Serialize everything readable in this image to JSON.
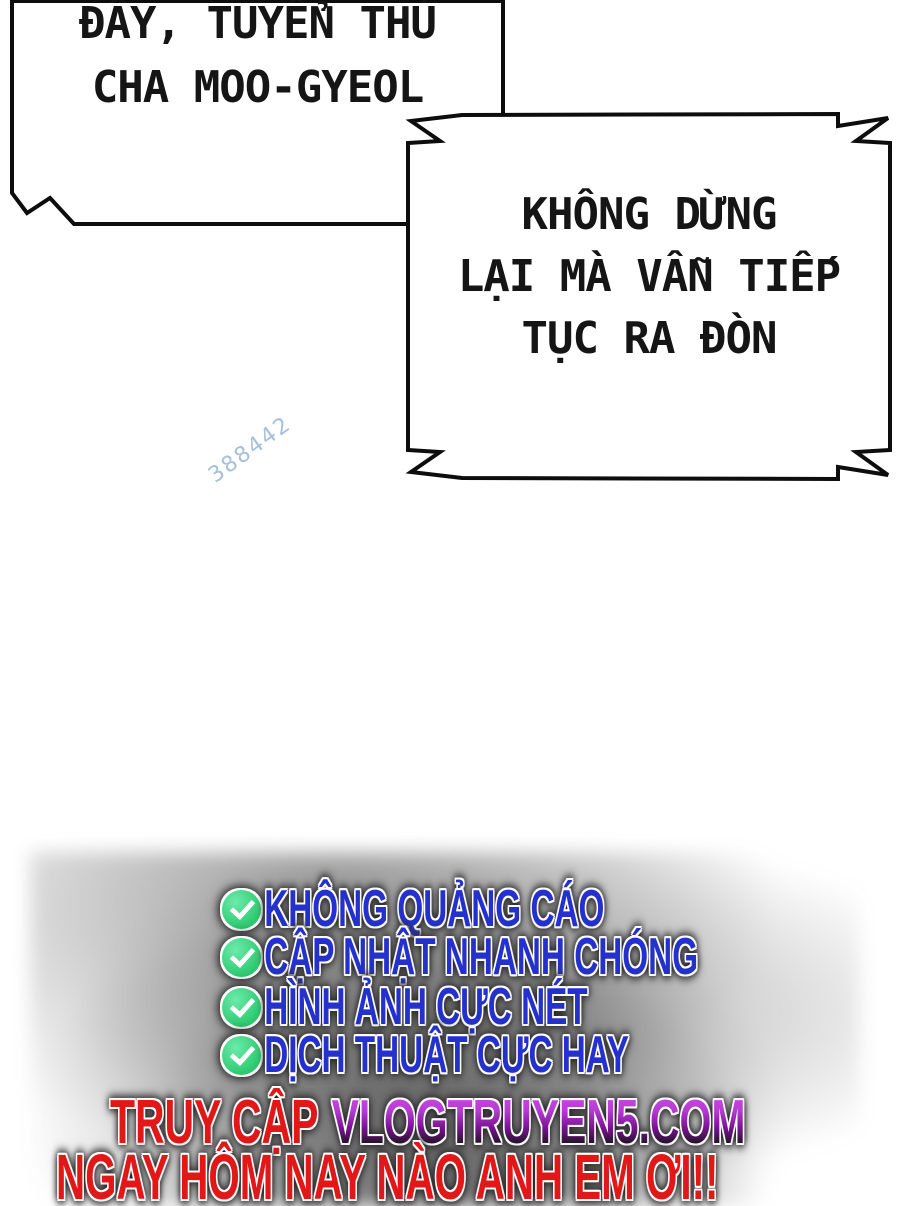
{
  "page": {
    "background": "#ffffff",
    "type": "manhwa-page"
  },
  "bubbles": {
    "bubble1": {
      "lines": [
        "ĐÂY, TUYỂN THỦ",
        "CHA MOO-GYEOL"
      ]
    },
    "bubble2": {
      "lines": [
        "KHÔNG DỪNG",
        "LẠI MÀ VẪN TIẾP",
        "TỤC RA ĐÒN"
      ]
    }
  },
  "watermark": {
    "text": "388442",
    "color": "#a7c0da"
  },
  "promo": {
    "checklist": {
      "icon": "check-circle-icon",
      "items": [
        "KHÔNG QUẢNG CÁO",
        "CẬP NHẬT NHANH CHÓNG",
        "HÌNH ẢNH CỰC NÉT",
        "DỊCH THUẬT CỰC HAY"
      ]
    },
    "cta": {
      "prefix": "TRUY CẬP",
      "site": "VLOGTRUYEN5.COM",
      "line2": "NGAY HÔM NAY NÀO ANH EM ƠI!!"
    },
    "colors": {
      "checklist_text": "#2431cc",
      "check_green": "#2fcb72",
      "cta_red": "#e21717",
      "site_purple_top": "#c94ae4",
      "site_purple_bottom": "#141414",
      "outline_white": "#ffffff"
    }
  }
}
